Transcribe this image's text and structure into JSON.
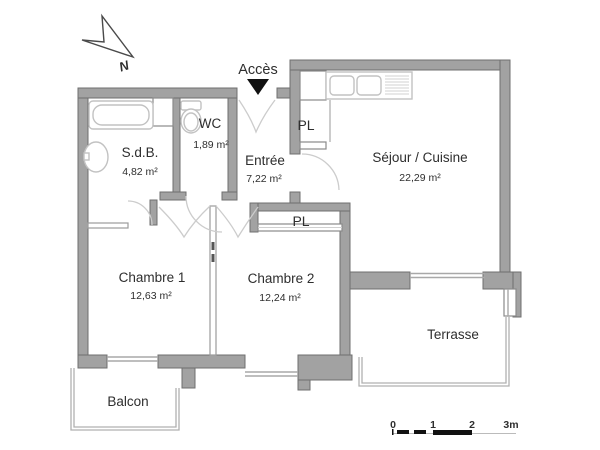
{
  "plan": {
    "access_label": "Accès",
    "north_label": "N",
    "rooms": [
      {
        "id": "sdb",
        "name": "S.d.B.",
        "area": "4,82 m²"
      },
      {
        "id": "wc",
        "name": "WC",
        "area": "1,89 m²"
      },
      {
        "id": "entree",
        "name": "Entrée",
        "area": "7,22 m²"
      },
      {
        "id": "pl_haut",
        "name": "PL",
        "area": ""
      },
      {
        "id": "sejour",
        "name": "Séjour / Cuisine",
        "area": "22,29 m²"
      },
      {
        "id": "pl_bas",
        "name": "PL",
        "area": ""
      },
      {
        "id": "chambre1",
        "name": "Chambre 1",
        "area": "12,63 m²"
      },
      {
        "id": "chambre2",
        "name": "Chambre 2",
        "area": "12,24 m²"
      },
      {
        "id": "terrasse",
        "name": "Terrasse",
        "area": ""
      },
      {
        "id": "balcon",
        "name": "Balcon",
        "area": ""
      }
    ],
    "scale": {
      "ticks": [
        "0",
        "1",
        "2",
        "3m"
      ]
    },
    "colors": {
      "wall": "#a2a2a2",
      "wall_stroke": "#6f6f6f",
      "fixture": "#c2c2c2",
      "thin_line": "#b0b0b0",
      "text": "#2e2e2e",
      "arrow": "#111111"
    }
  }
}
